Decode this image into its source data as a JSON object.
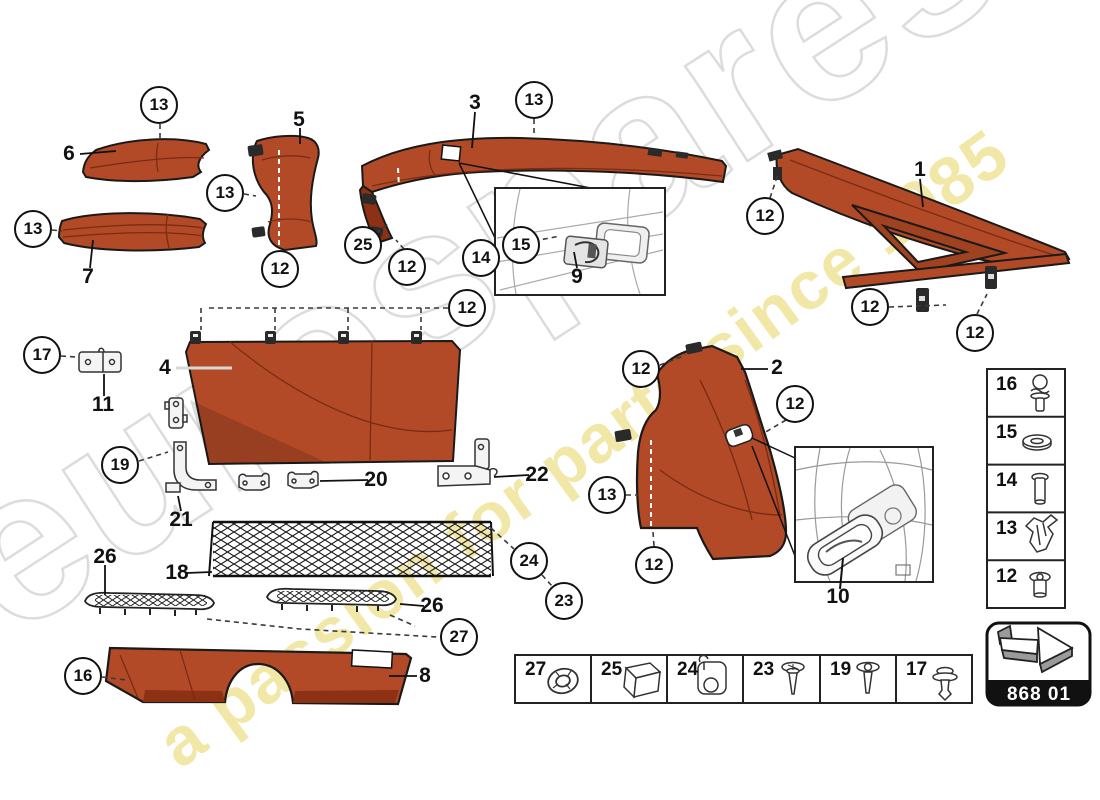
{
  "diagram": {
    "part_code": "868 01",
    "watermark": {
      "brand": "eurospares",
      "tagline": "a passion for parts since 1985"
    },
    "callouts": [
      {
        "label": "13"
      },
      {
        "label": "13"
      },
      {
        "label": "13"
      },
      {
        "label": "12"
      },
      {
        "label": "25"
      },
      {
        "label": "12"
      },
      {
        "label": "13"
      },
      {
        "label": "14"
      },
      {
        "label": "15"
      },
      {
        "label": "12"
      },
      {
        "label": "12"
      },
      {
        "label": "12"
      },
      {
        "label": "12"
      },
      {
        "label": "17"
      },
      {
        "label": "19"
      },
      {
        "label": "12"
      },
      {
        "label": "12"
      },
      {
        "label": "13"
      },
      {
        "label": "12"
      },
      {
        "label": "24"
      },
      {
        "label": "23"
      },
      {
        "label": "27"
      },
      {
        "label": "16"
      }
    ],
    "part_labels": [
      {
        "label": "6"
      },
      {
        "label": "7"
      },
      {
        "label": "5"
      },
      {
        "label": "3"
      },
      {
        "label": "9"
      },
      {
        "label": "1"
      },
      {
        "label": "11"
      },
      {
        "label": "4"
      },
      {
        "label": "21"
      },
      {
        "label": "20"
      },
      {
        "label": "22"
      },
      {
        "label": "2"
      },
      {
        "label": "10"
      },
      {
        "label": "18"
      },
      {
        "label": "26"
      },
      {
        "label": "26"
      },
      {
        "label": "8"
      }
    ],
    "fastener_column": [
      {
        "label": "16",
        "icon": "ball-stud-screw"
      },
      {
        "label": "15",
        "icon": "washer"
      },
      {
        "label": "14",
        "icon": "bolt"
      },
      {
        "label": "13",
        "icon": "expanding-clip"
      },
      {
        "label": "12",
        "icon": "screw"
      }
    ],
    "legend_row": [
      {
        "label": "27",
        "icon": "grommet-ring"
      },
      {
        "label": "25",
        "icon": "foam-block"
      },
      {
        "label": "24",
        "icon": "clamp-clip"
      },
      {
        "label": "23",
        "icon": "screw"
      },
      {
        "label": "19",
        "icon": "screw"
      },
      {
        "label": "17",
        "icon": "push-rivet"
      }
    ],
    "colors": {
      "trim": "#b24a27",
      "trim_dark": "#8c3114",
      "outline": "#1a1a1a",
      "watermark_gray": "#c9c9c9",
      "watermark_yellow": "#e4d052",
      "code_band": "#111111"
    }
  }
}
